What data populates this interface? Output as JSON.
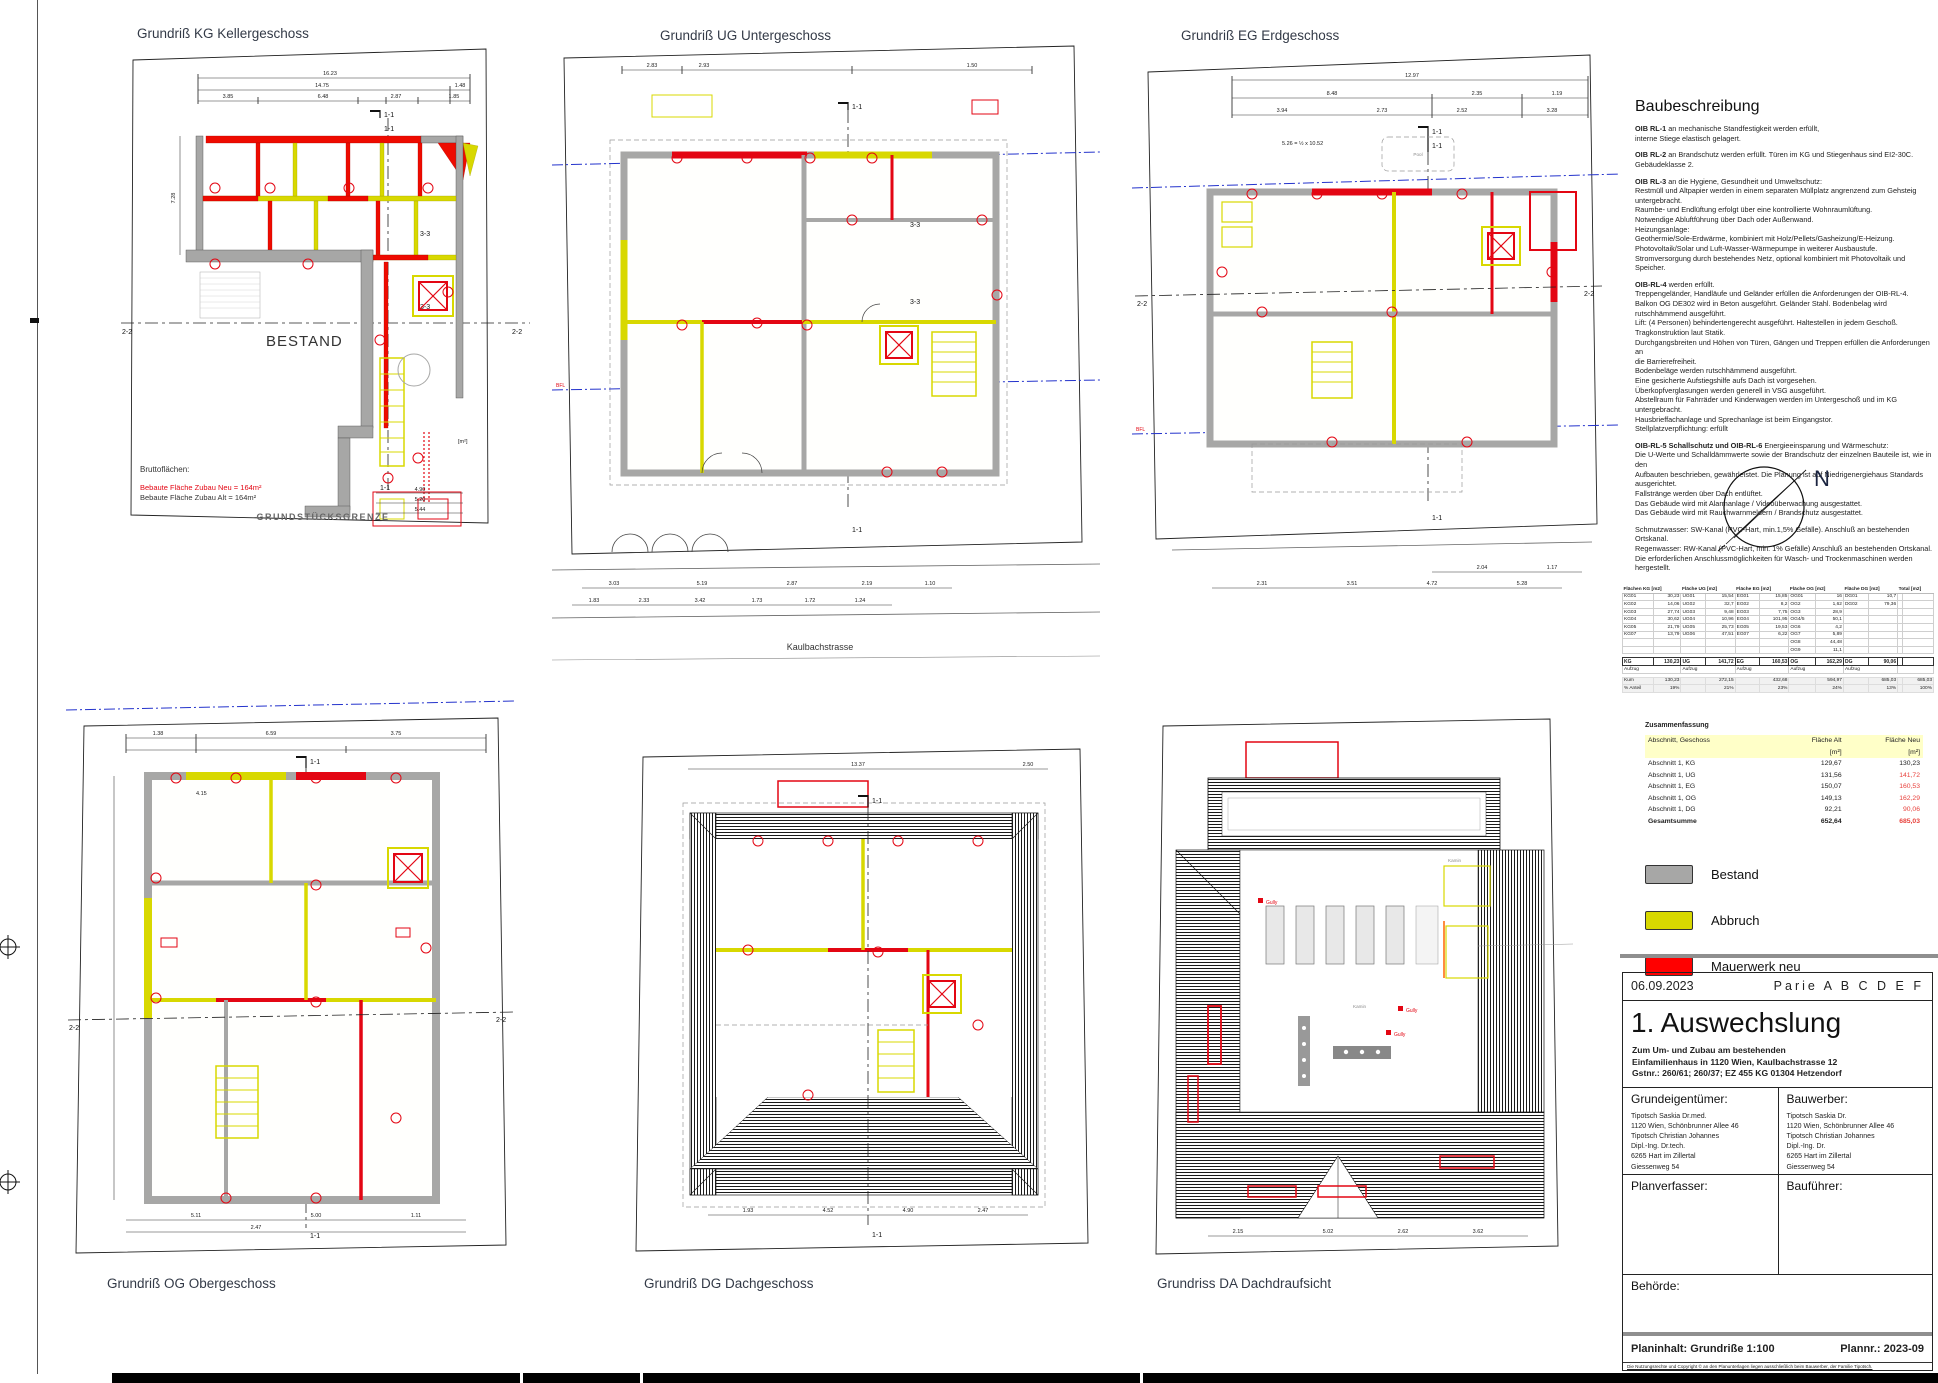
{
  "plans": {
    "kg": {
      "title": "Grundriß KG Kellergeschoss",
      "bestand_label": "BESTAND",
      "grenze_label": "GRUNDSTÜCKSGRENZE",
      "brutto_title": "Bruttoflächen:",
      "brutto_neu": "Bebaute Fläche Zubau Neu = 164m²",
      "brutto_alt": "Bebaute Fläche Zubau Alt = 164m²",
      "m2": "[m²]",
      "sec_11": "1-1",
      "sec_22": "2-2",
      "sec_33": "3-3",
      "dims_top": [
        "16.23",
        "14.75",
        "1.48",
        "3.85",
        "6.48",
        "2.87",
        "1.85"
      ],
      "dims_bottom": [
        "4.90",
        "5.20",
        "5.44"
      ],
      "dim_left": "7.28"
    },
    "ug": {
      "title": "Grundriß UG Untergeschoss",
      "street": "Kaulbachstrasse",
      "sec_11": "1-1",
      "sec_33": "3-3",
      "bfl": "BFL",
      "dims_top": [
        "2.83",
        "2.93",
        "1.50"
      ],
      "dims_bottom1": [
        "3.03",
        "5.19",
        "2.87",
        "2.19",
        "1.10"
      ],
      "dims_bottom2": [
        "1.83",
        "2.33",
        "3.42",
        "1.73",
        "1.72",
        "1.24"
      ]
    },
    "eg": {
      "title": "Grundriß EG Erdgeschoss",
      "sec_11": "1-1",
      "sec_22": "2-2",
      "bfl": "BFL",
      "pool": "Pool",
      "note": "5.26 = ½ x 10.52",
      "dims_top": [
        "12.97",
        "8.48",
        "2.35",
        "1.19"
      ],
      "dims_top2": [
        "3.94",
        "2.73",
        "2.52",
        "3.28"
      ],
      "dims_bottom1": [
        "2.04",
        "1.17"
      ],
      "dims_bottom2": [
        "2.31",
        "3.51",
        "4.72",
        "5.28"
      ]
    },
    "og": {
      "title": "Grundriß OG Obergeschoss",
      "sec_11": "1-1",
      "sec_22": "2-2",
      "room_dim": "4.15",
      "dims_top": [
        "1.38",
        "6.59",
        "3.75"
      ],
      "dims_bottom": [
        "5.11",
        "5.00",
        "1.11",
        "2.47"
      ]
    },
    "dg": {
      "title": "Grundriß DG Dachgeschoss",
      "sec_11": "1-1",
      "dims_top": [
        "13.37",
        "2.50"
      ],
      "dims_bottom": [
        "1.93",
        "4.52",
        "4.90",
        "2.47"
      ]
    },
    "da": {
      "title": "Grundriss DA Dachdraufsicht",
      "gully": "Gully",
      "kamin": "Kamin",
      "dims_bottom": [
        "2.15",
        "5.02",
        "2.62",
        "3.62"
      ]
    }
  },
  "north": {
    "label": "N"
  },
  "baubeschreibung": {
    "title": "Baubeschreibung",
    "paragraphs": [
      {
        "lead": "OIB RL-1",
        "text": "an mechanische Standfestigkeit werden erfüllt,\ninterne Stiege elastisch gelagert."
      },
      {
        "lead": "OIB RL-2",
        "text": "an Brandschutz werden erfüllt. Türen im KG und Stiegenhaus sind EI2-30C.\nGebäudeklasse 2."
      },
      {
        "lead": "OIB RL-3",
        "text": "an die Hygiene, Gesundheit und Umweltschutz:\nRestmüll und Altpapier werden in einem separaten Müllplatz angrenzend zum Gehsteig\nuntergebracht.\nRaumbe- und Endlüftung erfolgt über eine kontrollierte Wohnraumlüftung.\nNotwendige Abluftführung über Dach oder Außenwand.\nHeizungsanlage:\nGeothermie/Sole-Erdwärme, kombiniert mit Holz/Pellets/Gasheizung/E-Heizung.\nPhotovoltaik/Solar und Luft-Wasser-Wärmepumpe in weiterer Ausbaustufe.\nStromversorgung durch bestehendes Netz, optional kombiniert mit Photovoltaik und Speicher."
      },
      {
        "lead": "OIB-RL-4",
        "text": "werden erfüllt.\nTreppengeländer, Handläufe und Geländer erfüllen die Anforderungen der OIB-RL-4.\nBalkon OG DE302 wird in Beton ausgeführt. Geländer Stahl. Bodenbelag wird rutschhämmend ausgeführt.\nLift: (4 Personen) behindertengerecht ausgeführt. Haltestellen in jedem Geschoß.\nTragkonstruktion laut Statik.\nDurchgangsbreiten und Höhen von Türen, Gängen und Treppen erfüllen die Anforderungen an\ndie Barrierefreiheit.\nBodenbeläge werden rutschhämmend ausgeführt.\nEine gesicherte Aufstiegshilfe aufs Dach ist vorgesehen.\nÜberkopfverglasungen werden generell in VSG ausgeführt.\nAbstellraum für Fahrräder und Kinderwagen werden im Untergeschoß und im KG untergebracht.\nHausbrieffachanlage und Sprechanlage ist beim Eingangstor.\nStellplatzverpflichtung: erfüllt"
      },
      {
        "lead": "OIB-RL-5 Schallschutz und OIB-RL-6",
        "text": "Energieeinsparung und Wärmeschutz:\nDie U-Werte und Schalldämmwerte sowie der Brandschutz der einzelnen Bauteile ist, wie in den\nAufbauten beschrieben, gewährleistet. Die Planung ist auf Niedrigenergiehaus Standards\nausgerichtet.\nFallstränge werden über Dach entlüftet.\nDas Gebäude wird mit Alarmanlage / Videoüberwachung ausgestattet.\nDas Gebäude wird mit Rauchwarnmeldern / Brandschutz ausgestattet."
      },
      {
        "lead": "",
        "text": "Schmutzwasser: SW-Kanal (PVC-Hart, min.1,5% Gefälle). Anschluß an bestehenden Ortskanal.\nRegenwasser: RW-Kanal (PVC-Hart, min. 1% Gefälle) Anschluß an bestehenden Ortskanal.\nDie erforderlichen Anschlussmöglichkeiten für Wasch- und Trockenmaschinen werden hergestellt."
      }
    ]
  },
  "area_table": {
    "kum_label": "Kum",
    "pct_label": "% Anteil",
    "columns": [
      {
        "header": "Flächen KG [m2]",
        "rooms": [
          [
            "KG01",
            "30,23"
          ],
          [
            "KG02",
            "14,06"
          ],
          [
            "KG03",
            "27,74"
          ],
          [
            "KG04",
            "30,62"
          ],
          [
            "KG05",
            "21,79"
          ],
          [
            "KG07",
            "13,79"
          ],
          [
            "",
            ""
          ],
          [
            "",
            ""
          ]
        ],
        "sum": [
          "KG",
          "130,23"
        ],
        "aufzug": "Aufzug",
        "kum": "130,23",
        "pct": "19%"
      },
      {
        "header": "Fläche UG [m2]",
        "rooms": [
          [
            "UG01",
            "15,54"
          ],
          [
            "UG02",
            "32,7"
          ],
          [
            "UG03",
            "9,48"
          ],
          [
            "UG04",
            "10,96"
          ],
          [
            "UG05",
            "25,73"
          ],
          [
            "UG06",
            "47,51"
          ],
          [
            "",
            ""
          ],
          [
            "",
            ""
          ]
        ],
        "sum": [
          "UG",
          "141,72"
        ],
        "aufzug": "Aufzug",
        "kum": "272,15",
        "pct": "21%"
      },
      {
        "header": "Fläche EG [m2]",
        "rooms": [
          [
            "EG01",
            "15,85"
          ],
          [
            "EG02",
            "8,2"
          ],
          [
            "EG03",
            "7,75"
          ],
          [
            "EG04",
            "101,95"
          ],
          [
            "EG05",
            "19,53"
          ],
          [
            "EG07",
            "6,22"
          ],
          [
            "",
            ""
          ],
          [
            "",
            ""
          ]
        ],
        "sum": [
          "EG",
          "160,53"
        ],
        "aufzug": "Aufzug",
        "kum": "432,68",
        "pct": "23%"
      },
      {
        "header": "Fläche OG [m2]",
        "rooms": [
          [
            "OG01",
            "16"
          ],
          [
            "OG2",
            "1,62"
          ],
          [
            "OG3",
            "28,9"
          ],
          [
            "OG4/5",
            "50,1"
          ],
          [
            "OG6",
            "4,2"
          ],
          [
            "OG7",
            "5,89"
          ],
          [
            "OG8",
            "44,48"
          ],
          [
            "OG9",
            "11,1"
          ]
        ],
        "sum": [
          "OG",
          "162,29"
        ],
        "aufzug": "Aufzug",
        "kum": "594,97",
        "pct": "24%"
      },
      {
        "header": "Fläche DG [m2]",
        "rooms": [
          [
            "DG01",
            "10,7"
          ],
          [
            "DG02",
            "79,36"
          ],
          [
            "",
            ""
          ],
          [
            "",
            ""
          ],
          [
            "",
            ""
          ],
          [
            "",
            ""
          ],
          [
            "",
            ""
          ],
          [
            "",
            ""
          ]
        ],
        "sum": [
          "DG",
          "90,06"
        ],
        "aufzug": "Aufzug",
        "kum": "685,03",
        "pct": "13%"
      },
      {
        "header": "Total [m2]",
        "rooms": [
          [
            "",
            ""
          ],
          [
            "",
            ""
          ],
          [
            "",
            ""
          ],
          [
            "",
            ""
          ],
          [
            "",
            ""
          ],
          [
            "",
            ""
          ],
          [
            "",
            ""
          ],
          [
            "",
            ""
          ]
        ],
        "sum": [
          "",
          ""
        ],
        "aufzug": "",
        "kum": "685,03",
        "pct": "100%"
      }
    ]
  },
  "zusammenfassung": {
    "title": "Zusammenfassung",
    "headers": [
      "Abschnitt, Geschoss",
      "Fläche Alt",
      "Fläche Neu"
    ],
    "unit": "[m²]",
    "rows": [
      {
        "label": "Abschnitt 1, KG",
        "alt": "129,67",
        "neu": "130,23",
        "neu_red": false,
        "bold": false
      },
      {
        "label": "Abschnitt 1, UG",
        "alt": "131,56",
        "neu": "141,72",
        "neu_red": true,
        "bold": false
      },
      {
        "label": "Abschnitt 1, EG",
        "alt": "150,07",
        "neu": "160,53",
        "neu_red": true,
        "bold": false
      },
      {
        "label": "Abschnitt 1, OG",
        "alt": "149,13",
        "neu": "162,29",
        "neu_red": true,
        "bold": false
      },
      {
        "label": "Abschnitt 1, DG",
        "alt": "92,21",
        "neu": "90,06",
        "neu_red": true,
        "bold": false
      },
      {
        "label": "Gesamtsumme",
        "alt": "652,64",
        "neu": "685,03",
        "neu_red": true,
        "bold": true
      }
    ]
  },
  "legend": {
    "items": [
      {
        "label": "Bestand",
        "color": "#a7a7a6"
      },
      {
        "label": "Abbruch",
        "color": "#d8d800"
      },
      {
        "label": "Mauerwerk neu",
        "color": "#ff0000"
      }
    ]
  },
  "titleblock": {
    "date": "06.09.2023",
    "parie": "Parie A B C D E F",
    "title": "1. Auswechslung",
    "description": "Zum Um- und Zubau am bestehenden\nEinfamilienhaus in 1120 Wien, Kaulbachstrasse 12\nGstnr.: 260/61; 260/37;  EZ 455 KG 01304 Hetzendorf",
    "owner_label": "Grundeigentümer:",
    "owner": "Tipotsch Saskia Dr.med.\n1120 Wien, Schönbrunner Allee 46\nTipotsch Christian Johannes\nDipl.-Ing. Dr.tech.\n6265 Hart im Zillertal\nGiessenweg 54",
    "builder_label": "Bauwerber:",
    "builder": "Tipotsch Saskia Dr.\n1120 Wien, Schönbrunner Allee 46\nTipotsch Christian Johannes\nDipl.-Ing. Dr.\n6265 Hart im Zillertal\nGiessenweg 54",
    "planner_label": "Planverfasser:",
    "supervisor_label": "Bauführer:",
    "authority_label": "Behörde:",
    "content_label": "Planinhalt: Grundriße 1:100",
    "plannr_label": "Plannr.: 2023-09",
    "fineprint": "Die Nutzungsrechte und Copyright © an den Planunterlagen liegen ausschließlich beim Bauwerber, der Familie Tipotsch."
  }
}
